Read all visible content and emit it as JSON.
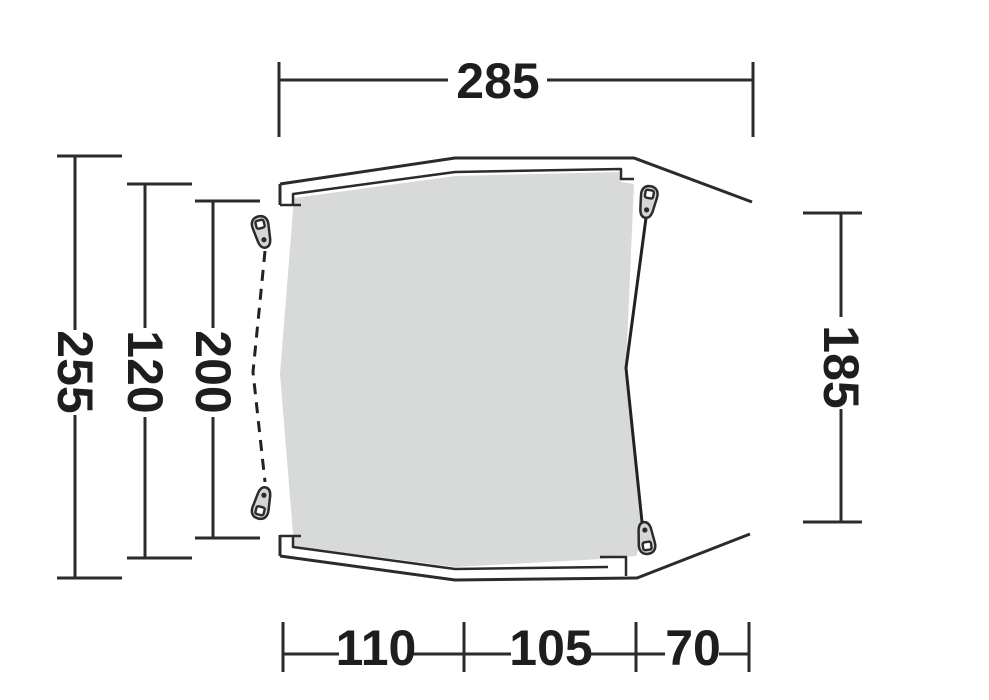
{
  "diagram": {
    "kind": "tent-floorplan-dimension-drawing",
    "dimensions": {
      "top_width": "285",
      "left_outer_depth": "255",
      "left_middle_depth": "120",
      "left_inner_depth": "200",
      "right_depth": "185",
      "bottom_section_left": "110",
      "bottom_section_middle": "105",
      "bottom_section_right": "70"
    },
    "colors": {
      "line": "#2b2b2b",
      "text": "#1e1e1e",
      "floor_fill": "#d8d9d9",
      "zipper_pull_fill": "#d4d6d5",
      "background": "#ffffff"
    }
  }
}
